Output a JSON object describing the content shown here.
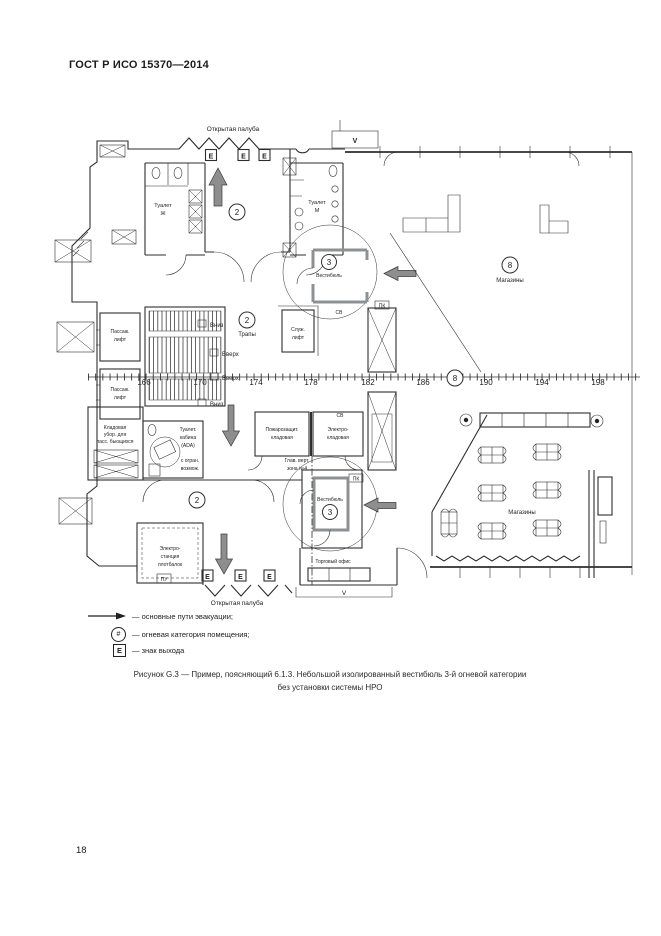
{
  "page": {
    "header": "ГОСТ Р ИСО 15370—2014",
    "page_number": "18"
  },
  "caption": {
    "line1": "Рисунок G.3 — Пример, поясняющий 6.1.3. Небольшой изолированный вестибюль 3-й огневой категории",
    "line2": "без установки системы НРО"
  },
  "legend": {
    "evacuation": "— основные пути эвакуации;",
    "fire_category": "— огневая категория помещения;",
    "exit": "— знак выхода",
    "fire_category_symbol": "#",
    "exit_symbol": "E"
  },
  "colors": {
    "line": "#2e2e2e",
    "arrow_fill": "#8e8e8e"
  },
  "plan": {
    "deck_top": "Открытая палуба",
    "deck_bottom": "Открытая палуба",
    "exit": "E",
    "v_top": "V",
    "v_bottom": "V",
    "cat2": "2",
    "cat3": "3",
    "cat8": "8",
    "toilet_w_l1": "Туалет",
    "toilet_w_l2": "Ж",
    "toilet_m_l1": "Туалет",
    "toilet_m_l2": "М",
    "vestibule_top": "Вестибюль",
    "vestibule_bottom": "Вестибюль",
    "shops_top": "Магазины",
    "shops_bottom": "Магазины",
    "stairs": "Трапы",
    "down1": "Вниз",
    "up1": "Вверх",
    "up2": "Вверх",
    "down2": "Вниз",
    "pass_lift_l1": "Пассаж.",
    "pass_lift_l2": "лифт",
    "serv_lift_l1": "Служ.",
    "serv_lift_l2": "лифт",
    "ada_l1": "Туалет.",
    "ada_l2": "кабина",
    "ada_l3": "(ADA)",
    "ada_l4": "с огран.",
    "ada_l5": "возмож.",
    "store_left_l1": "Кладовая",
    "store_left_l2": "убор. для",
    "store_left_l3": "пасс. бьющихся",
    "fire_store_l1": "Пожарозащит.",
    "fire_store_l2": "кладовая",
    "electro_store_l1": "Электро-",
    "electro_store_l2": "кладовая",
    "mvz_l1": "Глав. верт.",
    "mvz_l2": "зона №4",
    "power_l1": "Электро-",
    "power_l2": "станция",
    "power_l3": "плотбалок",
    "sales_office": "Торговый офис",
    "pk": "ПК",
    "pu": "ПУ",
    "sv": "СВ",
    "frames": [
      "166",
      "170",
      "174",
      "178",
      "182",
      "186",
      "190",
      "194",
      "198"
    ]
  }
}
